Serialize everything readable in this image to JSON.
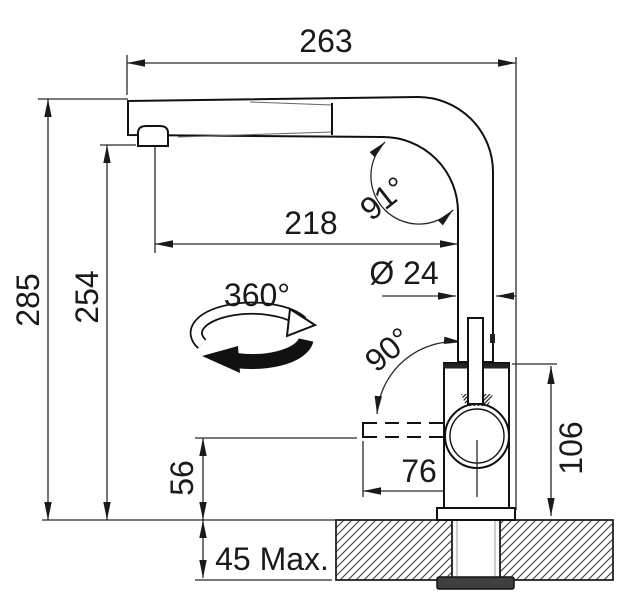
{
  "drawing": {
    "type": "technical-dimension-diagram",
    "labels": {
      "overall_width": "263",
      "overall_height": "285",
      "spout_outlet_height": "254",
      "spout_reach": "218",
      "spout_bend_angle": "91°",
      "swivel_range": "360°",
      "pipe_diameter": "Ø 24",
      "handle_swing_angle": "90°",
      "body_height": "106",
      "handle_reach": "76",
      "handle_clearance_height": "56",
      "max_deck_thickness": "45 Max."
    },
    "colors": {
      "line": "#1a1a1a",
      "background": "#ffffff",
      "nut": "#3f3f3f"
    }
  }
}
